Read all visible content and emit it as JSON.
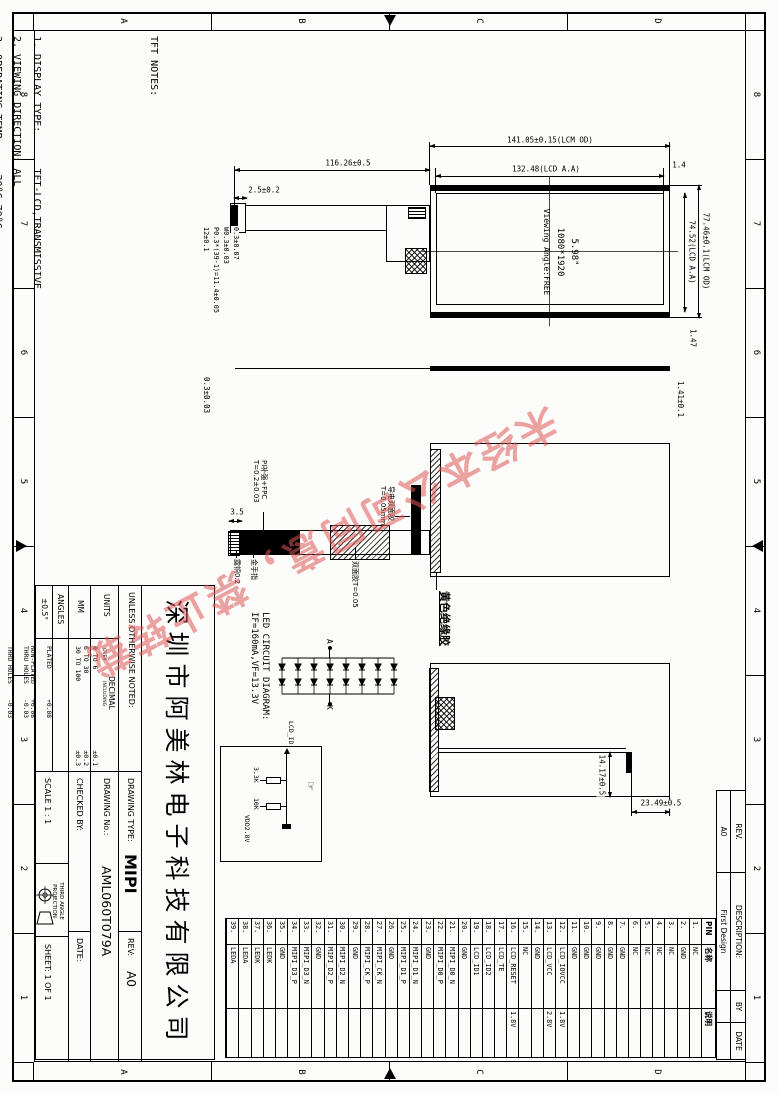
{
  "sheet": {
    "zone_numbers": [
      "8",
      "7",
      "6",
      "5",
      "4",
      "3",
      "2",
      "1"
    ],
    "zone_letters": [
      "D",
      "C",
      "B",
      "A"
    ]
  },
  "notes": {
    "title": "TFT NOTES:",
    "lines": [
      "1. DISPLAY TYPE:      TFT-LCD,TRANSMISSIVE",
      "2. VIEWING DIRECTION: ALL",
      "3. OPERATING TEMP:    -20°C~70°C",
      "4. STORAGE TEMP:      -30°C~80°C",
      "5. DRIVER IC:         NT35532",
      "6. BACK LIGHT:  8*2 CHIP WHITE LED,Vf=12V,If=160mA",
      "7. UNMARKED TOLERANCE:±0.2"
    ]
  },
  "front_view": {
    "dim_lcm_w": "141.05±0.15(LCM OD)",
    "dim_aa_w": "132.48(LCD A.A)",
    "dim_gap_top": "1.4",
    "dim_lcm_h": "77.46±0.1(LCM OD)",
    "dim_aa_h": "74.52(LCD A.A)",
    "dim_gap_right": "1.47",
    "dim_fpc_len": "116.26±0.5",
    "dim_fpc_offset": "2.5±0.2",
    "dim_conn_w": "12±0.1",
    "dim_pitch": "P0.3*(39-1)=11.4±0.05",
    "dim_finger_w": "W0.3±0.03",
    "dim_finger_t": "0.3±0.07",
    "panel_size": "5.98\"",
    "panel_res": "1080*1920",
    "panel_view": "Viewing Angle:FREE"
  },
  "side_view": {
    "dim_top": "1.41±0.1",
    "dim_bottom": "0.3±0.03"
  },
  "back_view": {
    "label_stiffener_1": "PI补强+FPC",
    "label_stiffener_2": "T=0.2±0.03",
    "label_gold": "金手指",
    "label_copper": "露铜0.2",
    "label_tape": "双面胶T=0.05",
    "label_cond_tape_1": "导电双面胶",
    "label_cond_tape_2": "T=0.05mm",
    "label_yellow": "黄色绝缘胶",
    "dim_finger": "3.5"
  },
  "folded_view": {
    "dim_v": "23.49±0.5",
    "dim_h": "14.17±0.5"
  },
  "led_circuit": {
    "title_1": "LED CIRCUIT DIAGRAM:",
    "title_2": "IF=160mA,VF=13.3V",
    "anode": "A",
    "cathode": "K",
    "net": "LCD_ID",
    "r1": "3.3K",
    "r2": "10K",
    "vdd": "VDD2.8V",
    "hand": "☞"
  },
  "pin_table": {
    "headers": [
      "PIN",
      "名称",
      "说明"
    ],
    "rows": [
      {
        "pin": "1.",
        "name": "NC",
        "desc": ""
      },
      {
        "pin": "2.",
        "name": "GND",
        "desc": ""
      },
      {
        "pin": "3.",
        "name": "NC",
        "desc": ""
      },
      {
        "pin": "4.",
        "name": "NC",
        "desc": ""
      },
      {
        "pin": "5.",
        "name": "NC",
        "desc": ""
      },
      {
        "pin": "6.",
        "name": "NC",
        "desc": ""
      },
      {
        "pin": "7.",
        "name": "GND",
        "desc": ""
      },
      {
        "pin": "8.",
        "name": "GND",
        "desc": ""
      },
      {
        "pin": "9.",
        "name": "GND",
        "desc": ""
      },
      {
        "pin": "10.",
        "name": "GND",
        "desc": ""
      },
      {
        "pin": "11.",
        "name": "GND",
        "desc": ""
      },
      {
        "pin": "12.",
        "name": "LCD_IOVCC",
        "desc": "1.8V"
      },
      {
        "pin": "13.",
        "name": "LCD_VCC",
        "desc": "2.8V"
      },
      {
        "pin": "14.",
        "name": "GND",
        "desc": ""
      },
      {
        "pin": "15.",
        "name": "NC",
        "desc": ""
      },
      {
        "pin": "16.",
        "name": "LCD_RESET",
        "desc": "1.8V"
      },
      {
        "pin": "17.",
        "name": "LCD_TE",
        "desc": ""
      },
      {
        "pin": "18.",
        "name": "LCD_ID2",
        "desc": ""
      },
      {
        "pin": "19.",
        "name": "LCD_ID1",
        "desc": ""
      },
      {
        "pin": "20.",
        "name": "GND",
        "desc": ""
      },
      {
        "pin": "21.",
        "name": "MIPI_D0_N",
        "desc": ""
      },
      {
        "pin": "22.",
        "name": "MIPI_D0_P",
        "desc": ""
      },
      {
        "pin": "23.",
        "name": "GND",
        "desc": ""
      },
      {
        "pin": "24.",
        "name": "MIPI_D1_N",
        "desc": ""
      },
      {
        "pin": "25.",
        "name": "MIPI_D1_P",
        "desc": ""
      },
      {
        "pin": "26.",
        "name": "GND",
        "desc": ""
      },
      {
        "pin": "27.",
        "name": "MIPI_CK_N",
        "desc": ""
      },
      {
        "pin": "28.",
        "name": "MIPI_CK_P",
        "desc": ""
      },
      {
        "pin": "29.",
        "name": "GND",
        "desc": ""
      },
      {
        "pin": "30.",
        "name": "MIPI_D2_N",
        "desc": ""
      },
      {
        "pin": "31.",
        "name": "MIPI_D2_P",
        "desc": ""
      },
      {
        "pin": "32.",
        "name": "GND",
        "desc": ""
      },
      {
        "pin": "33.",
        "name": "MIPI_D3_N",
        "desc": ""
      },
      {
        "pin": "34.",
        "name": "MIPI_D3_P",
        "desc": ""
      },
      {
        "pin": "35.",
        "name": "GND",
        "desc": ""
      },
      {
        "pin": "36.",
        "name": "LEDK",
        "desc": ""
      },
      {
        "pin": "37.",
        "name": "LEDK",
        "desc": ""
      },
      {
        "pin": "38.",
        "name": "LEDA",
        "desc": ""
      },
      {
        "pin": "39.",
        "name": "LEDA",
        "desc": ""
      }
    ]
  },
  "rev_table": {
    "headers": [
      "REV.",
      "DESCRIPTION:",
      "BY",
      "DATE"
    ],
    "row": {
      "rev": "A0",
      "description": "First Design",
      "by": "",
      "date": ""
    }
  },
  "title_block": {
    "company": "深圳市阿美林电子科技有限公司",
    "unless": "UNLESS OTHERWISE NOTED:",
    "units_label": "UNITS",
    "units_value": "MM",
    "decimal_label": "DECIMAL",
    "decimal_over": "OVER",
    "decimal_including": "INCLUDING",
    "decimal_rows": [
      {
        "range": "0  TO  6",
        "tol": "±0.1"
      },
      {
        "range": "6  TO  30",
        "tol": "±0.2"
      },
      {
        "range": "30 TO 100",
        "tol": "±0.3"
      }
    ],
    "angles_label": "ANGLES",
    "angles_value": "±0.5°",
    "plated_1": "PLATED        +0.08",
    "plated_2": "THRU HOLES    -0.03",
    "non_plated_1": "NON-PLATED    +0.08",
    "non_plated_2": "THRU HOLES    -0.03",
    "drawing_type_label": "DRAWING TYPE:",
    "drawing_type": "MIPI",
    "rev_label": "REV:",
    "rev": "A0",
    "drawing_no_label": "DRAWING No.:",
    "drawing_no": "AML060T079A",
    "checked_label": "CHECKED BY:",
    "date_label": "DATE:",
    "scale": "SCALE  1 : 1",
    "projection": "THIRD ANGLE PROJECTION",
    "sheet": "SHEET: 1 OF 1"
  },
  "watermark": "未经本公司同意，禁止转载"
}
